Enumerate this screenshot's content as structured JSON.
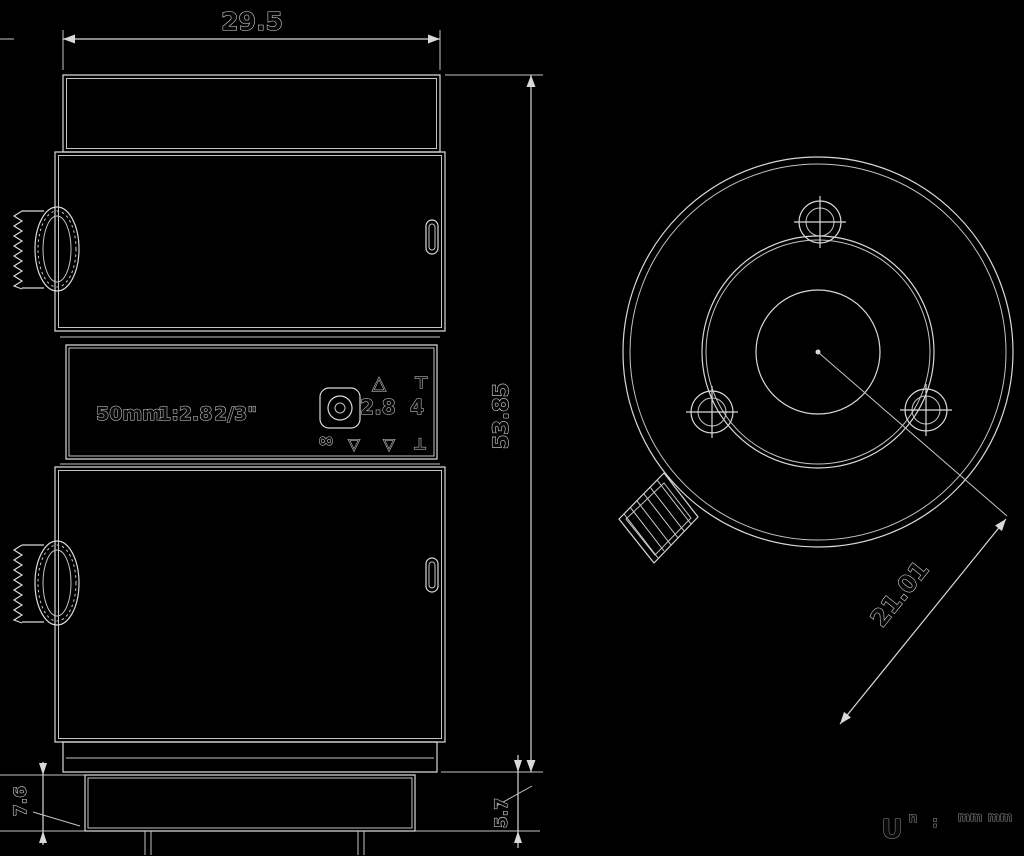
{
  "drawing": {
    "description": "Machine-vision lens mechanical drawing, side view and rear view, white lines on black",
    "colors": {
      "background": "#000000",
      "line": "#d9d9d9",
      "dim_text_fill": "#070707",
      "dim_text_outline": "#dedede"
    },
    "side_view": {
      "dimensions": {
        "top_width": "29.5",
        "right_height": "53.85",
        "bottom_left": "7.6",
        "bottom_right": "5.7"
      },
      "barrel_label": {
        "focal_length": "50mm",
        "max_aperture": "1:2.8",
        "image_format": "2/3\""
      },
      "aperture_scale": {
        "f_numbers": [
          "2.8",
          "4"
        ],
        "upper_marks": [
          "△",
          "⊤"
        ],
        "lower_marks": [
          "∞",
          "▽",
          "▽",
          "⊥"
        ]
      }
    },
    "back_view": {
      "dimensions": {
        "diagonal": "21.01"
      }
    },
    "corner_note": {
      "fragments": [
        "U",
        "n",
        ":",
        "mm",
        "mm"
      ]
    }
  }
}
